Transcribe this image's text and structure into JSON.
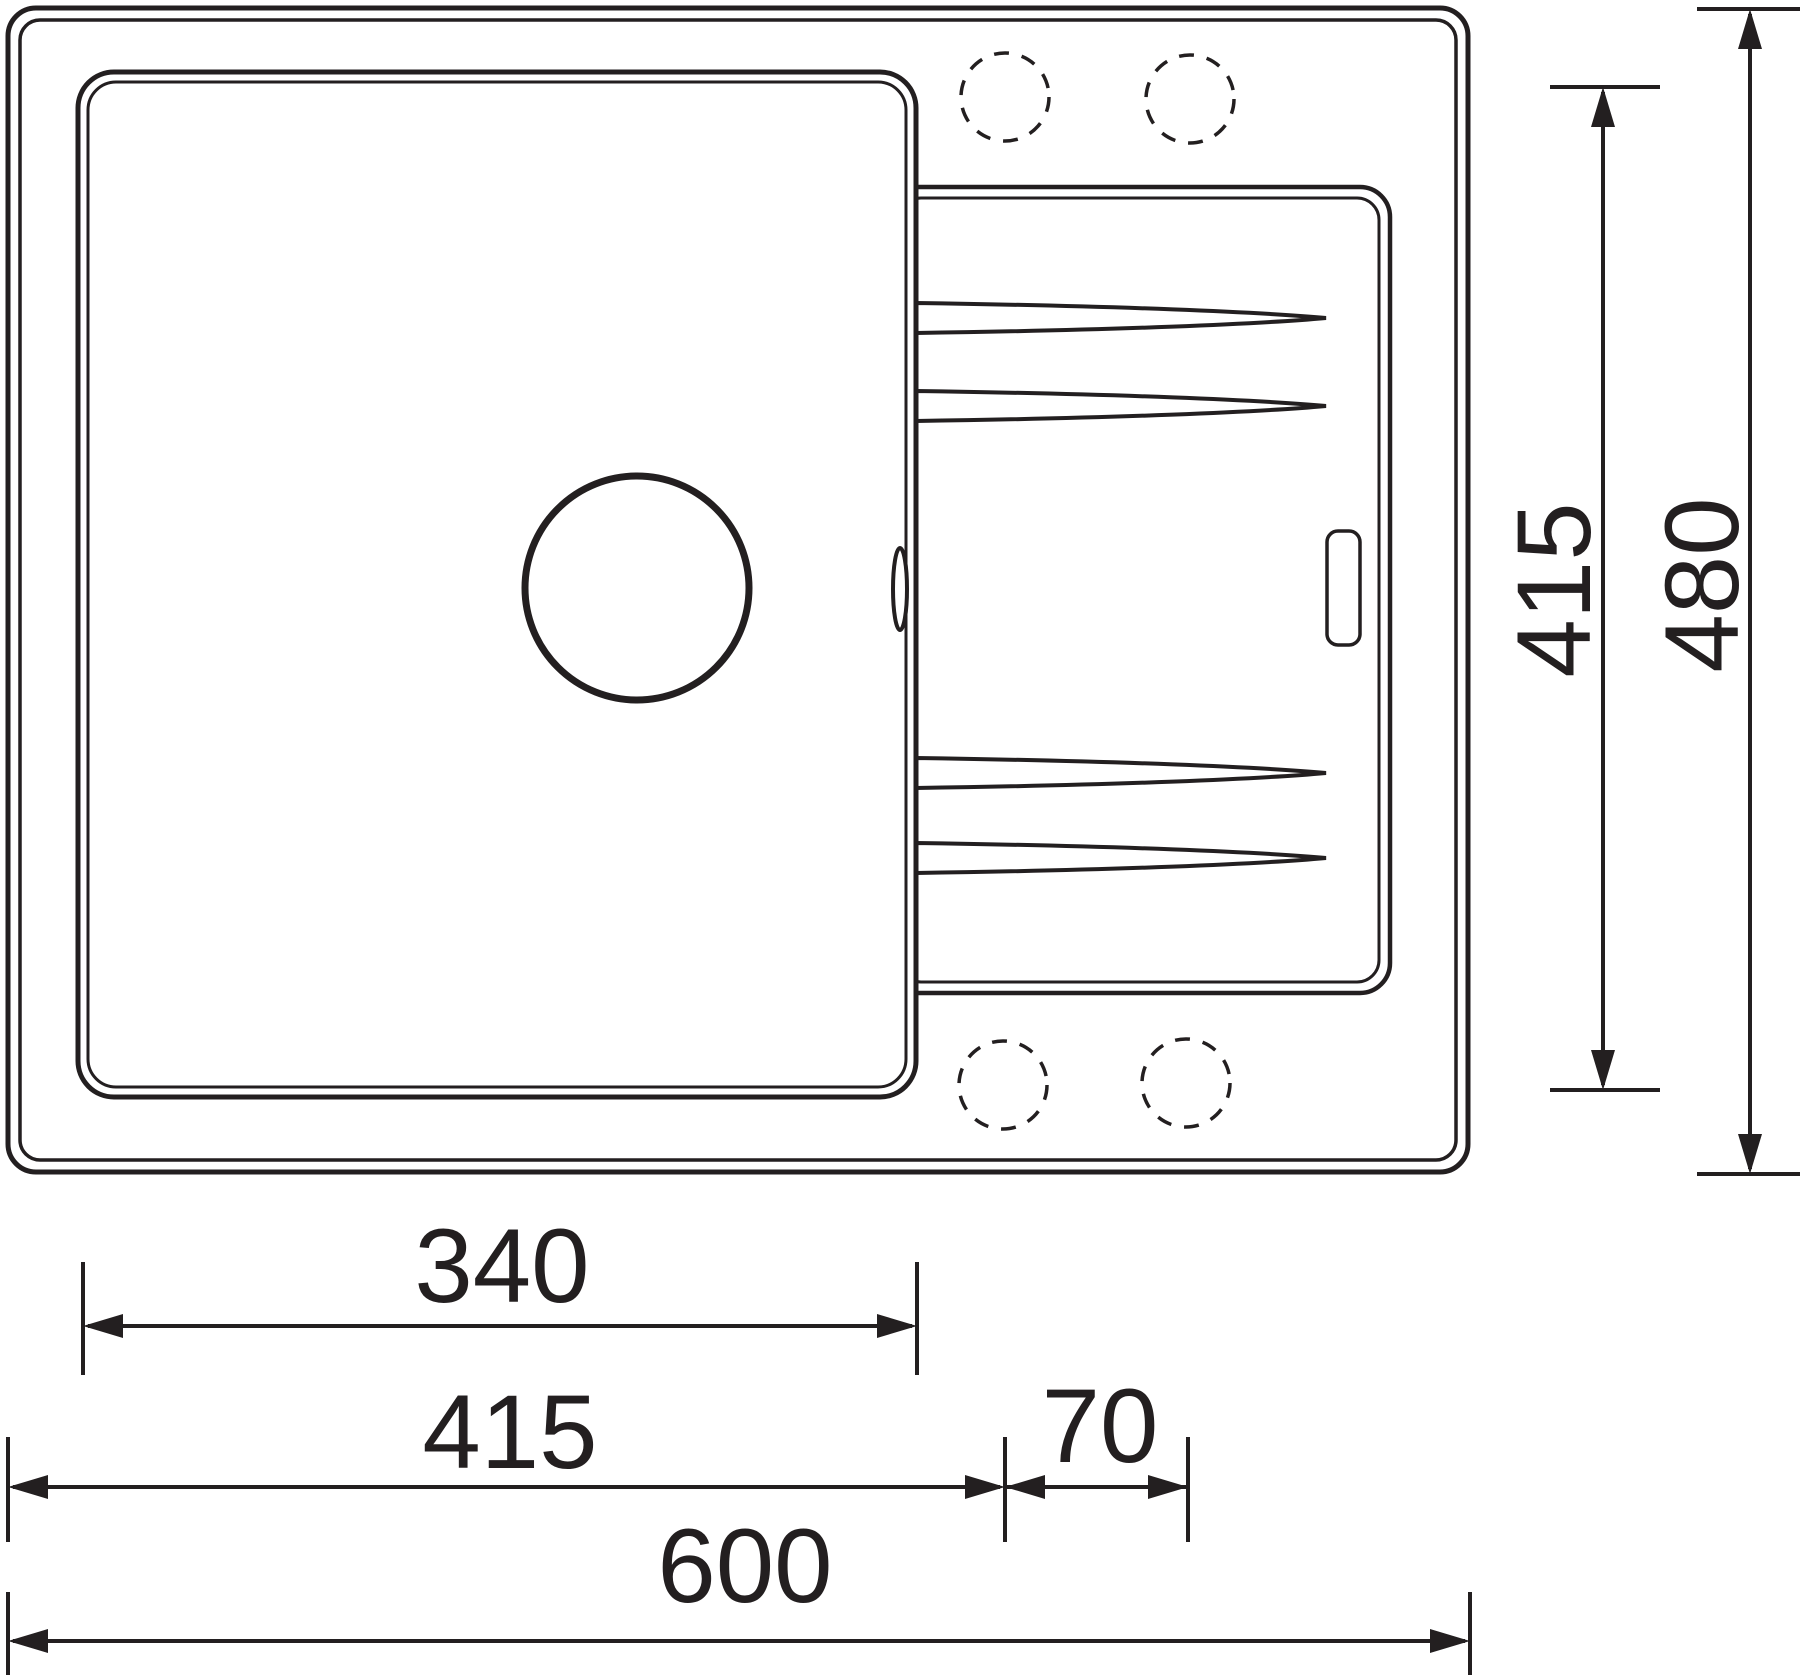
{
  "diagram": {
    "title": "sink-top-view-dimension-drawing",
    "colors": {
      "line": "#231f20",
      "background": "#ffffff"
    },
    "features": {
      "sink_body": "outer sink rim",
      "bowl": "main bowl with drain hole",
      "drainer": "drainer board with grooves",
      "tap_holes": "4 dashed pre-drilled tap hole positions",
      "overflow_slot": "overflow slot on drainer"
    },
    "dimensions": {
      "bottom": [
        {
          "id": "bowl-width",
          "value": "340"
        },
        {
          "id": "edge-to-first-tap",
          "value": "415"
        },
        {
          "id": "tap-spacing",
          "value": "70"
        },
        {
          "id": "overall-width",
          "value": "600"
        }
      ],
      "right": [
        {
          "id": "bowl-depth",
          "value": "415"
        },
        {
          "id": "overall-depth",
          "value": "480"
        }
      ]
    }
  }
}
